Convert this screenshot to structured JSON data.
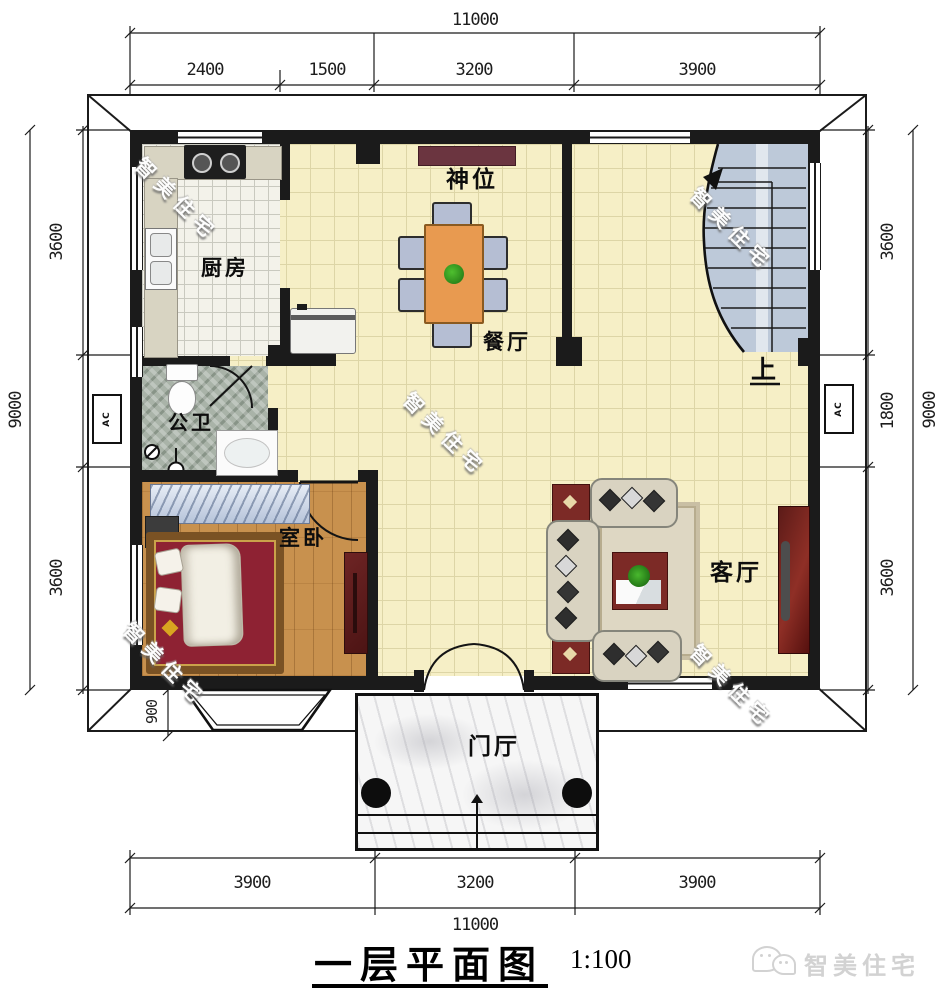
{
  "meta": {
    "plan_title": "一层平面图",
    "scale": "1:100",
    "brand": "智美住宅",
    "watermark": "智美住宅",
    "ac_label": "AC"
  },
  "rooms": {
    "kitchen": "厨房",
    "shrine": "神位",
    "dining": "餐厅",
    "bathroom": "公卫",
    "bedroom": "室卧",
    "living": "客厅",
    "foyer": "门厅",
    "stairs_up": "上"
  },
  "dimensions": {
    "top_total": "11000",
    "top_segments": [
      "2400",
      "1500",
      "3200",
      "3900"
    ],
    "bottom_total": "11000",
    "bottom_segments": [
      "3900",
      "3200",
      "3900"
    ],
    "left_total": "9000",
    "left_segments": [
      "3600",
      "3600"
    ],
    "right_total": "9000",
    "right_segments": [
      "3600",
      "1800",
      "3600"
    ],
    "bay_window_depth": "900"
  }
}
